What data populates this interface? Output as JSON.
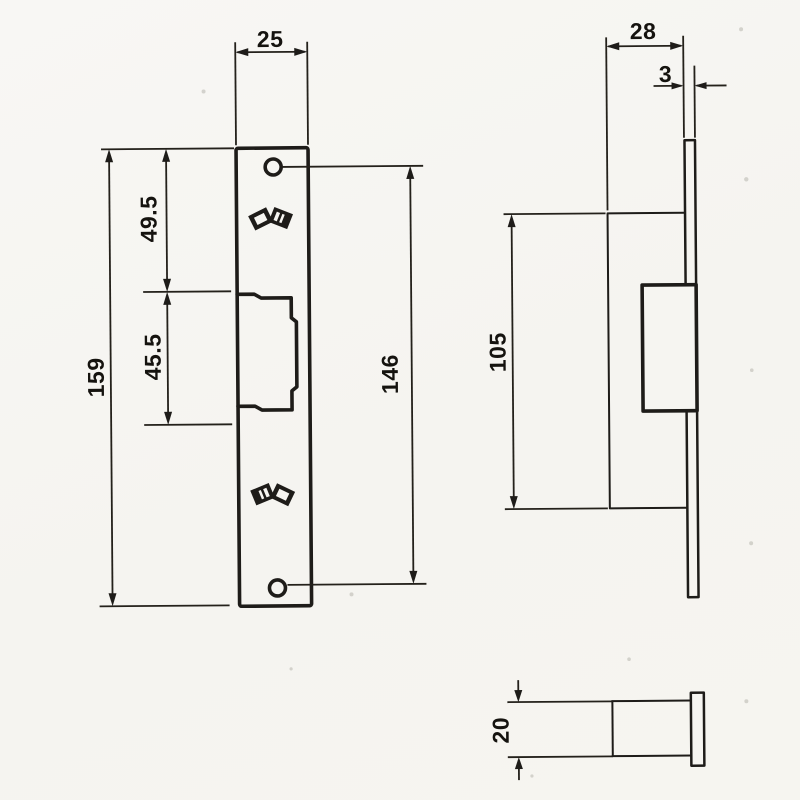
{
  "dimensions": {
    "front": {
      "plate_width": "25",
      "top_hole_offset": "49.5",
      "cutout_height": "45.5",
      "plate_height": "159",
      "hole_spacing": "146"
    },
    "side": {
      "body_depth": "28",
      "faceplate_thickness": "3",
      "body_height": "105"
    },
    "plan": {
      "body_width": "20"
    }
  },
  "icons": {
    "maker_mark": "double-square-fan-mark",
    "arrowheads": "filled-triangle"
  },
  "colors": {
    "ink": "#1e1c19",
    "paper": "#f6f5f1"
  }
}
